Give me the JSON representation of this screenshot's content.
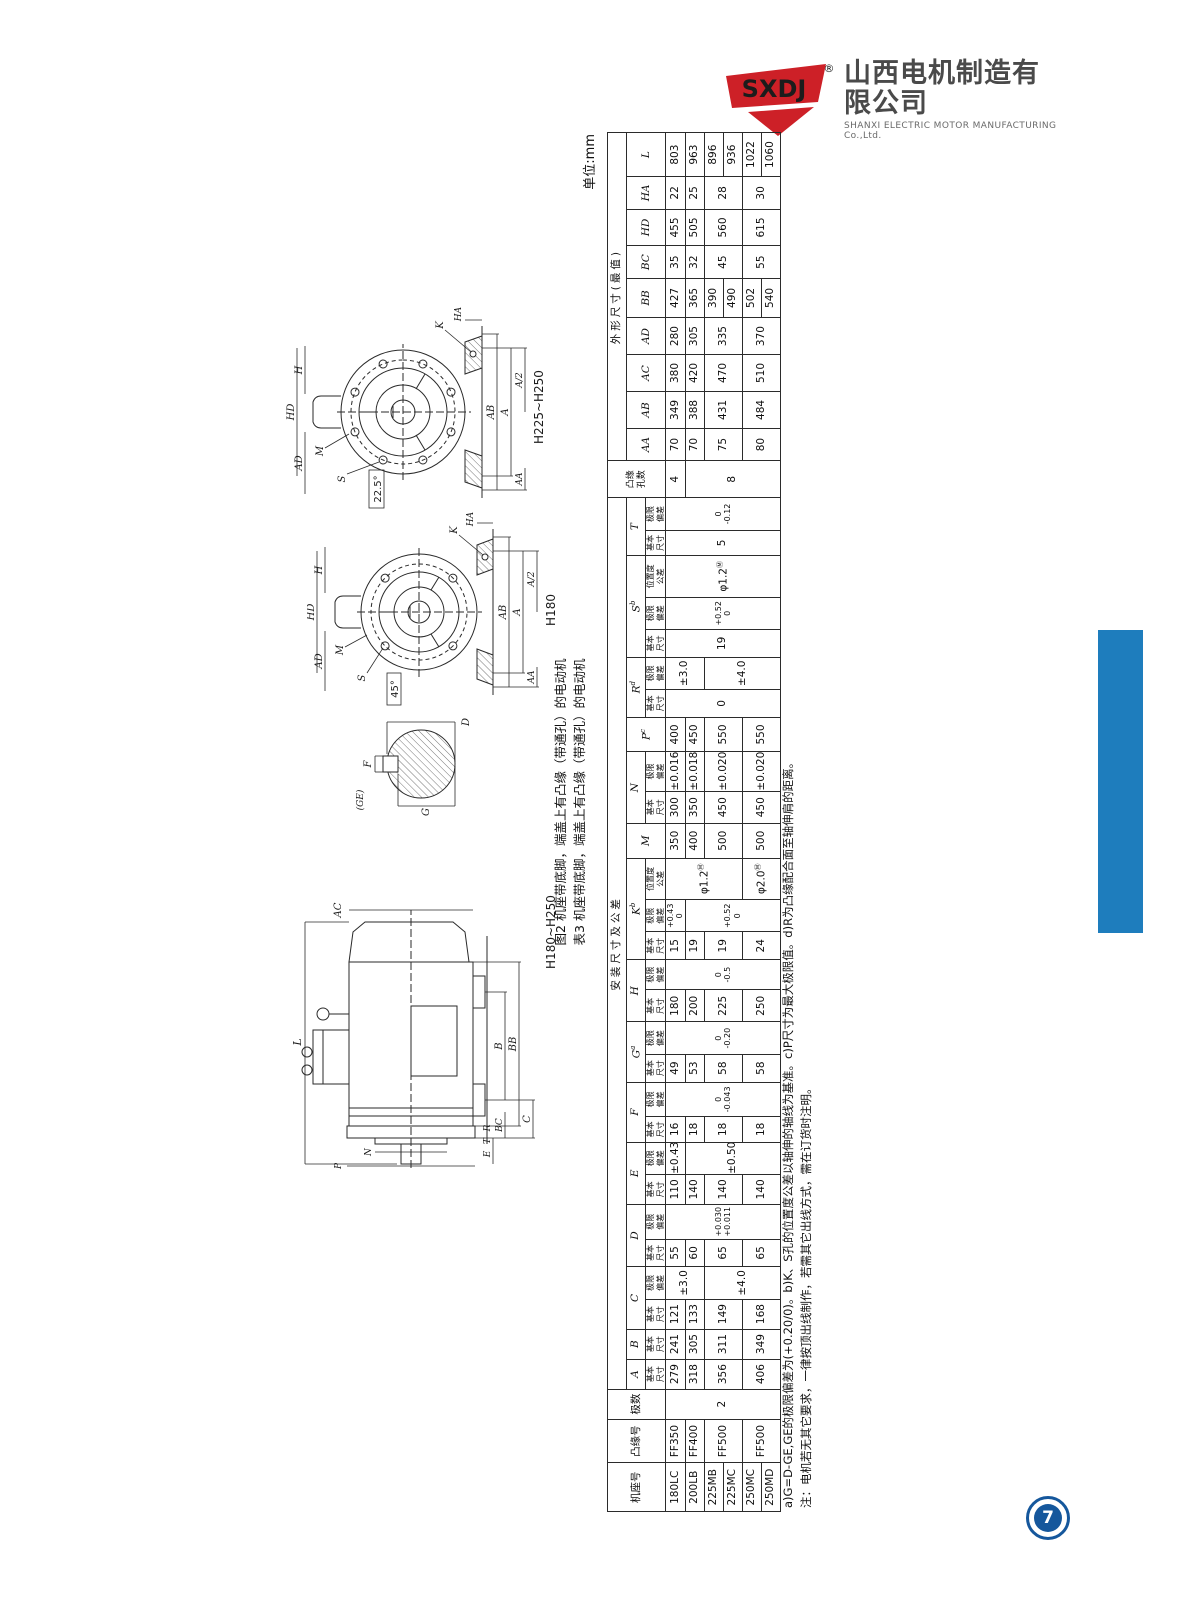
{
  "page": {
    "unit_label": "单位:mm",
    "page_number": "7"
  },
  "logo": {
    "brand": "SXDJ",
    "reg": "®",
    "company_cn": "山西电机制造有限公司",
    "company_en": "SHANXI ELECTRIC MOTOR MANUFACTURING Co.,Ltd."
  },
  "captions": {
    "fig2": "图2 机座带底脚，端盖上有凸缘（带通孔）的电动机",
    "table3": "表3 机座带底脚，端盖上有凸缘（带通孔）的电动机"
  },
  "notes": {
    "line1": "a)G=D-GE,GE的极限偏差为(+0.20/0)。b)K、S孔的位置度公差以轴伸的轴线为基准。c)P尺寸为最大极限值。d)R为凸缘配合面至轴伸肩的距离。",
    "line2": "注：电机若无其它要求，一律按顶出线制作，若需其它出线方式，需在订货时注明。"
  },
  "drawings": {
    "side": {
      "frame_label": "H180~H250",
      "d_L": "L",
      "d_AC": "AC",
      "d_B": "B",
      "d_BB": "BB",
      "d_BC": "BC",
      "d_C": "C",
      "d_E": "E",
      "d_N": "N",
      "d_P": "P",
      "d_T": "T",
      "d_R": "R"
    },
    "shaft": {
      "d_GE": "(GE)",
      "d_G": "G",
      "d_F": "F",
      "d_D": "D"
    },
    "end4": {
      "frame_label": "H180",
      "angle": "45°",
      "d_HD": "HD",
      "d_H": "H",
      "d_AD": "AD",
      "d_M": "M",
      "d_S": "S",
      "d_K": "K",
      "d_HA": "HA",
      "d_AB": "AB",
      "d_A": "A",
      "d_A2": "A/2",
      "d_AA": "AA"
    },
    "end8": {
      "frame_label": "H225~H250",
      "angle": "22.5°",
      "d_HD": "HD",
      "d_H": "H",
      "d_AD": "AD",
      "d_M": "M",
      "d_S": "S",
      "d_K": "K",
      "d_HA": "HA",
      "d_AB": "AB",
      "d_A": "A",
      "d_A2": "A/2",
      "d_AA": "AA"
    }
  },
  "table": {
    "colw": [
      42,
      38,
      26,
      26,
      26,
      26,
      28,
      24,
      30,
      26,
      28,
      22,
      30,
      24,
      28,
      28,
      26,
      24,
      28,
      36,
      30,
      28,
      34,
      30,
      24,
      28,
      24,
      28,
      36,
      22,
      28,
      32,
      28,
      32,
      32,
      32,
      34,
      28,
      32,
      28,
      38
    ],
    "rows": [
      [
        {
          "t": "机座号",
          "rs": 3,
          "k": "hdr"
        },
        {
          "t": "凸缘号",
          "rs": 3,
          "k": "hdr"
        },
        {
          "t": "极数",
          "rs": 3,
          "k": "hdr"
        },
        {
          "t": "安装尺寸及公差",
          "cs": 28,
          "k": "grp"
        },
        {
          "t": "凸缘",
          "t2": "孔数",
          "rs": 3,
          "k": "hdr2"
        },
        {
          "t": "外形尺寸(最值)",
          "cs": 9,
          "k": "grp"
        }
      ],
      [
        {
          "t": "A",
          "k": "ltr"
        },
        {
          "t": "B",
          "k": "ltr"
        },
        {
          "t": "C",
          "cs": 2,
          "k": "ltr"
        },
        {
          "t": "D",
          "cs": 2,
          "k": "ltr"
        },
        {
          "t": "E",
          "cs": 2,
          "k": "ltr"
        },
        {
          "t": "F",
          "cs": 2,
          "k": "ltr"
        },
        {
          "t": "G",
          "sup": "a",
          "cs": 2,
          "k": "ltr"
        },
        {
          "t": "H",
          "cs": 2,
          "k": "ltr"
        },
        {
          "t": "K",
          "sup": "b",
          "cs": 3,
          "k": "ltr"
        },
        {
          "t": "M",
          "rs": 2,
          "k": "ltr"
        },
        {
          "t": "N",
          "cs": 2,
          "k": "ltr"
        },
        {
          "t": "P",
          "sup": "c",
          "rs": 2,
          "k": "ltr"
        },
        {
          "t": "R",
          "sup": "d",
          "cs": 2,
          "k": "ltr"
        },
        {
          "t": "S",
          "sup": "b",
          "cs": 3,
          "k": "ltr"
        },
        {
          "t": "T",
          "cs": 2,
          "k": "ltr"
        },
        {
          "t": "AA",
          "rs": 2,
          "k": "ltr"
        },
        {
          "t": "AB",
          "rs": 2,
          "k": "ltr"
        },
        {
          "t": "AC",
          "rs": 2,
          "k": "ltr"
        },
        {
          "t": "AD",
          "rs": 2,
          "k": "ltr"
        },
        {
          "t": "BB",
          "rs": 2,
          "k": "ltr"
        },
        {
          "t": "BC",
          "rs": 2,
          "k": "ltr"
        },
        {
          "t": "HD",
          "rs": 2,
          "k": "ltr"
        },
        {
          "t": "HA",
          "rs": 2,
          "k": "ltr"
        },
        {
          "t": "L",
          "rs": 2,
          "k": "ltr"
        }
      ],
      [
        {
          "t": "基本",
          "t2": "尺寸",
          "k": "sub"
        },
        {
          "t": "基本",
          "t2": "尺寸",
          "k": "sub"
        },
        {
          "t": "基本",
          "t2": "尺寸",
          "k": "sub"
        },
        {
          "t": "极限",
          "t2": "偏差",
          "k": "sub"
        },
        {
          "t": "基本",
          "t2": "尺寸",
          "k": "sub"
        },
        {
          "t": "极限",
          "t2": "偏差",
          "k": "sub"
        },
        {
          "t": "基本",
          "t2": "尺寸",
          "k": "sub"
        },
        {
          "t": "极限",
          "t2": "偏差",
          "k": "sub"
        },
        {
          "t": "基本",
          "t2": "尺寸",
          "k": "sub"
        },
        {
          "t": "极限",
          "t2": "偏差",
          "k": "sub"
        },
        {
          "t": "基本",
          "t2": "尺寸",
          "k": "sub"
        },
        {
          "t": "极限",
          "t2": "偏差",
          "k": "sub"
        },
        {
          "t": "基本",
          "t2": "尺寸",
          "k": "sub"
        },
        {
          "t": "极限",
          "t2": "偏差",
          "k": "sub"
        },
        {
          "t": "基本",
          "t2": "尺寸",
          "k": "sub"
        },
        {
          "t": "极限",
          "t2": "偏差",
          "k": "sub"
        },
        {
          "t": "位置度",
          "t2": "公差",
          "k": "sub"
        },
        {
          "t": "基本",
          "t2": "尺寸",
          "k": "sub"
        },
        {
          "t": "极限",
          "t2": "偏差",
          "k": "sub"
        },
        {
          "t": "基本",
          "t2": "尺寸",
          "k": "sub"
        },
        {
          "t": "极限",
          "t2": "偏差",
          "k": "sub"
        },
        {
          "t": "基本",
          "t2": "尺寸",
          "k": "sub"
        },
        {
          "t": "极限",
          "t2": "偏差",
          "k": "sub"
        },
        {
          "t": "位置度",
          "t2": "公差",
          "k": "sub"
        },
        {
          "t": "基本",
          "t2": "尺寸",
          "k": "sub"
        },
        {
          "t": "极限",
          "t2": "偏差",
          "k": "sub"
        }
      ],
      [
        {
          "t": "180LC",
          "k": "frm"
        },
        {
          "t": "FF350",
          "k": "frm"
        },
        {
          "t": "2",
          "rs": 6
        },
        {
          "t": "279"
        },
        {
          "t": "241"
        },
        {
          "t": "121"
        },
        {
          "t": "±3.0",
          "rs": 2,
          "k": "tol1"
        },
        {
          "t": "55"
        },
        {
          "t": "+0.030",
          "t2": "+0.011",
          "rs": 6,
          "k": "tol"
        },
        {
          "t": "110"
        },
        {
          "t": "±0.43",
          "k": "tol1"
        },
        {
          "t": "16"
        },
        {
          "t": "0",
          "t2": "-0.043",
          "rs": 6,
          "k": "tol"
        },
        {
          "t": "49"
        },
        {
          "t": "0",
          "t2": "-0.20",
          "rs": 6,
          "k": "tol"
        },
        {
          "t": "180"
        },
        {
          "t": "0",
          "t2": "-0.5",
          "rs": 6,
          "k": "tol"
        },
        {
          "t": "15"
        },
        {
          "t": "+0.43",
          "t2": "0",
          "k": "tol"
        },
        {
          "t": "φ1.2",
          "sup": "Ⓜ",
          "rs": 4,
          "k": "pos"
        },
        {
          "t": "350"
        },
        {
          "t": "300"
        },
        {
          "t": "±0.016",
          "k": "tol1"
        },
        {
          "t": "400"
        },
        {
          "t": "0",
          "rs": 6
        },
        {
          "t": "±3.0",
          "rs": 2,
          "k": "tol1"
        },
        {
          "t": "19",
          "rs": 6
        },
        {
          "t": "+0.52",
          "t2": "0",
          "rs": 6,
          "k": "tol"
        },
        {
          "t": "φ1.2",
          "sup": "Ⓜ",
          "rs": 6,
          "k": "pos"
        },
        {
          "t": "5",
          "rs": 6
        },
        {
          "t": "0",
          "t2": "-0.12",
          "rs": 6,
          "k": "tol"
        },
        {
          "t": "4"
        },
        {
          "t": "70"
        },
        {
          "t": "349"
        },
        {
          "t": "380"
        },
        {
          "t": "280"
        },
        {
          "t": "427"
        },
        {
          "t": "35"
        },
        {
          "t": "455"
        },
        {
          "t": "22"
        },
        {
          "t": "803"
        }
      ],
      [
        {
          "t": "200LB",
          "k": "frm"
        },
        {
          "t": "FF400",
          "k": "frm"
        },
        {
          "t": "318"
        },
        {
          "t": "305"
        },
        {
          "t": "133"
        },
        {
          "t": "60"
        },
        {
          "t": "140"
        },
        {
          "t": "±0.50",
          "rs": 5,
          "k": "tol1"
        },
        {
          "t": "18"
        },
        {
          "t": "53"
        },
        {
          "t": "200"
        },
        {
          "t": "19"
        },
        {
          "t": "+0.52",
          "t2": "0",
          "rs": 5,
          "k": "tol"
        },
        {
          "t": "400"
        },
        {
          "t": "350"
        },
        {
          "t": "±0.018",
          "k": "tol1"
        },
        {
          "t": "450"
        },
        {
          "t": "8",
          "rs": 5
        },
        {
          "t": "70"
        },
        {
          "t": "388"
        },
        {
          "t": "420"
        },
        {
          "t": "305"
        },
        {
          "t": "365"
        },
        {
          "t": "32"
        },
        {
          "t": "505"
        },
        {
          "t": "25"
        },
        {
          "t": "963"
        }
      ],
      [
        {
          "t": "225MB",
          "k": "frm"
        },
        {
          "t": "FF500",
          "rs": 2,
          "k": "frm"
        },
        {
          "t": "356",
          "rs": 2
        },
        {
          "t": "311",
          "rs": 2
        },
        {
          "t": "149",
          "rs": 2
        },
        {
          "t": "±4.0",
          "rs": 4,
          "k": "tol1"
        },
        {
          "t": "65",
          "rs": 2
        },
        {
          "t": "140",
          "rs": 2
        },
        {
          "t": "18",
          "rs": 2
        },
        {
          "t": "58",
          "rs": 2
        },
        {
          "t": "225",
          "rs": 2
        },
        {
          "t": "19",
          "rs": 2
        },
        {
          "t": "500",
          "rs": 2
        },
        {
          "t": "450",
          "rs": 2
        },
        {
          "t": "±0.020",
          "rs": 2,
          "k": "tol1"
        },
        {
          "t": "550",
          "rs": 2
        },
        {
          "t": "±4.0",
          "rs": 4,
          "k": "tol1"
        },
        {
          "t": "75",
          "rs": 2
        },
        {
          "t": "431",
          "rs": 2
        },
        {
          "t": "470",
          "rs": 2
        },
        {
          "t": "335",
          "rs": 2
        },
        {
          "t": "390"
        },
        {
          "t": "45",
          "rs": 2
        },
        {
          "t": "560",
          "rs": 2
        },
        {
          "t": "28",
          "rs": 2
        },
        {
          "t": "896"
        }
      ],
      [
        {
          "t": "225MC",
          "k": "frm"
        },
        {
          "t": "490"
        },
        {
          "t": "936"
        }
      ],
      [
        {
          "t": "250MC",
          "k": "frm"
        },
        {
          "t": "FF500",
          "rs": 2,
          "k": "frm"
        },
        {
          "t": "406",
          "rs": 2
        },
        {
          "t": "349",
          "rs": 2
        },
        {
          "t": "168",
          "rs": 2
        },
        {
          "t": "65",
          "rs": 2
        },
        {
          "t": "140",
          "rs": 2
        },
        {
          "t": "18",
          "rs": 2
        },
        {
          "t": "58",
          "rs": 2
        },
        {
          "t": "250",
          "rs": 2
        },
        {
          "t": "24",
          "rs": 2
        },
        {
          "t": "φ2.0",
          "sup": "Ⓜ",
          "rs": 2,
          "k": "pos"
        },
        {
          "t": "500",
          "rs": 2
        },
        {
          "t": "450",
          "rs": 2
        },
        {
          "t": "±0.020",
          "rs": 2,
          "k": "tol1"
        },
        {
          "t": "550",
          "rs": 2
        },
        {
          "t": "80",
          "rs": 2
        },
        {
          "t": "484",
          "rs": 2
        },
        {
          "t": "510",
          "rs": 2
        },
        {
          "t": "370",
          "rs": 2
        },
        {
          "t": "502"
        },
        {
          "t": "55",
          "rs": 2
        },
        {
          "t": "615",
          "rs": 2
        },
        {
          "t": "30",
          "rs": 2
        },
        {
          "t": "1022"
        }
      ],
      [
        {
          "t": "250MD",
          "k": "frm"
        },
        {
          "t": "540"
        },
        {
          "t": "1060"
        }
      ]
    ]
  }
}
